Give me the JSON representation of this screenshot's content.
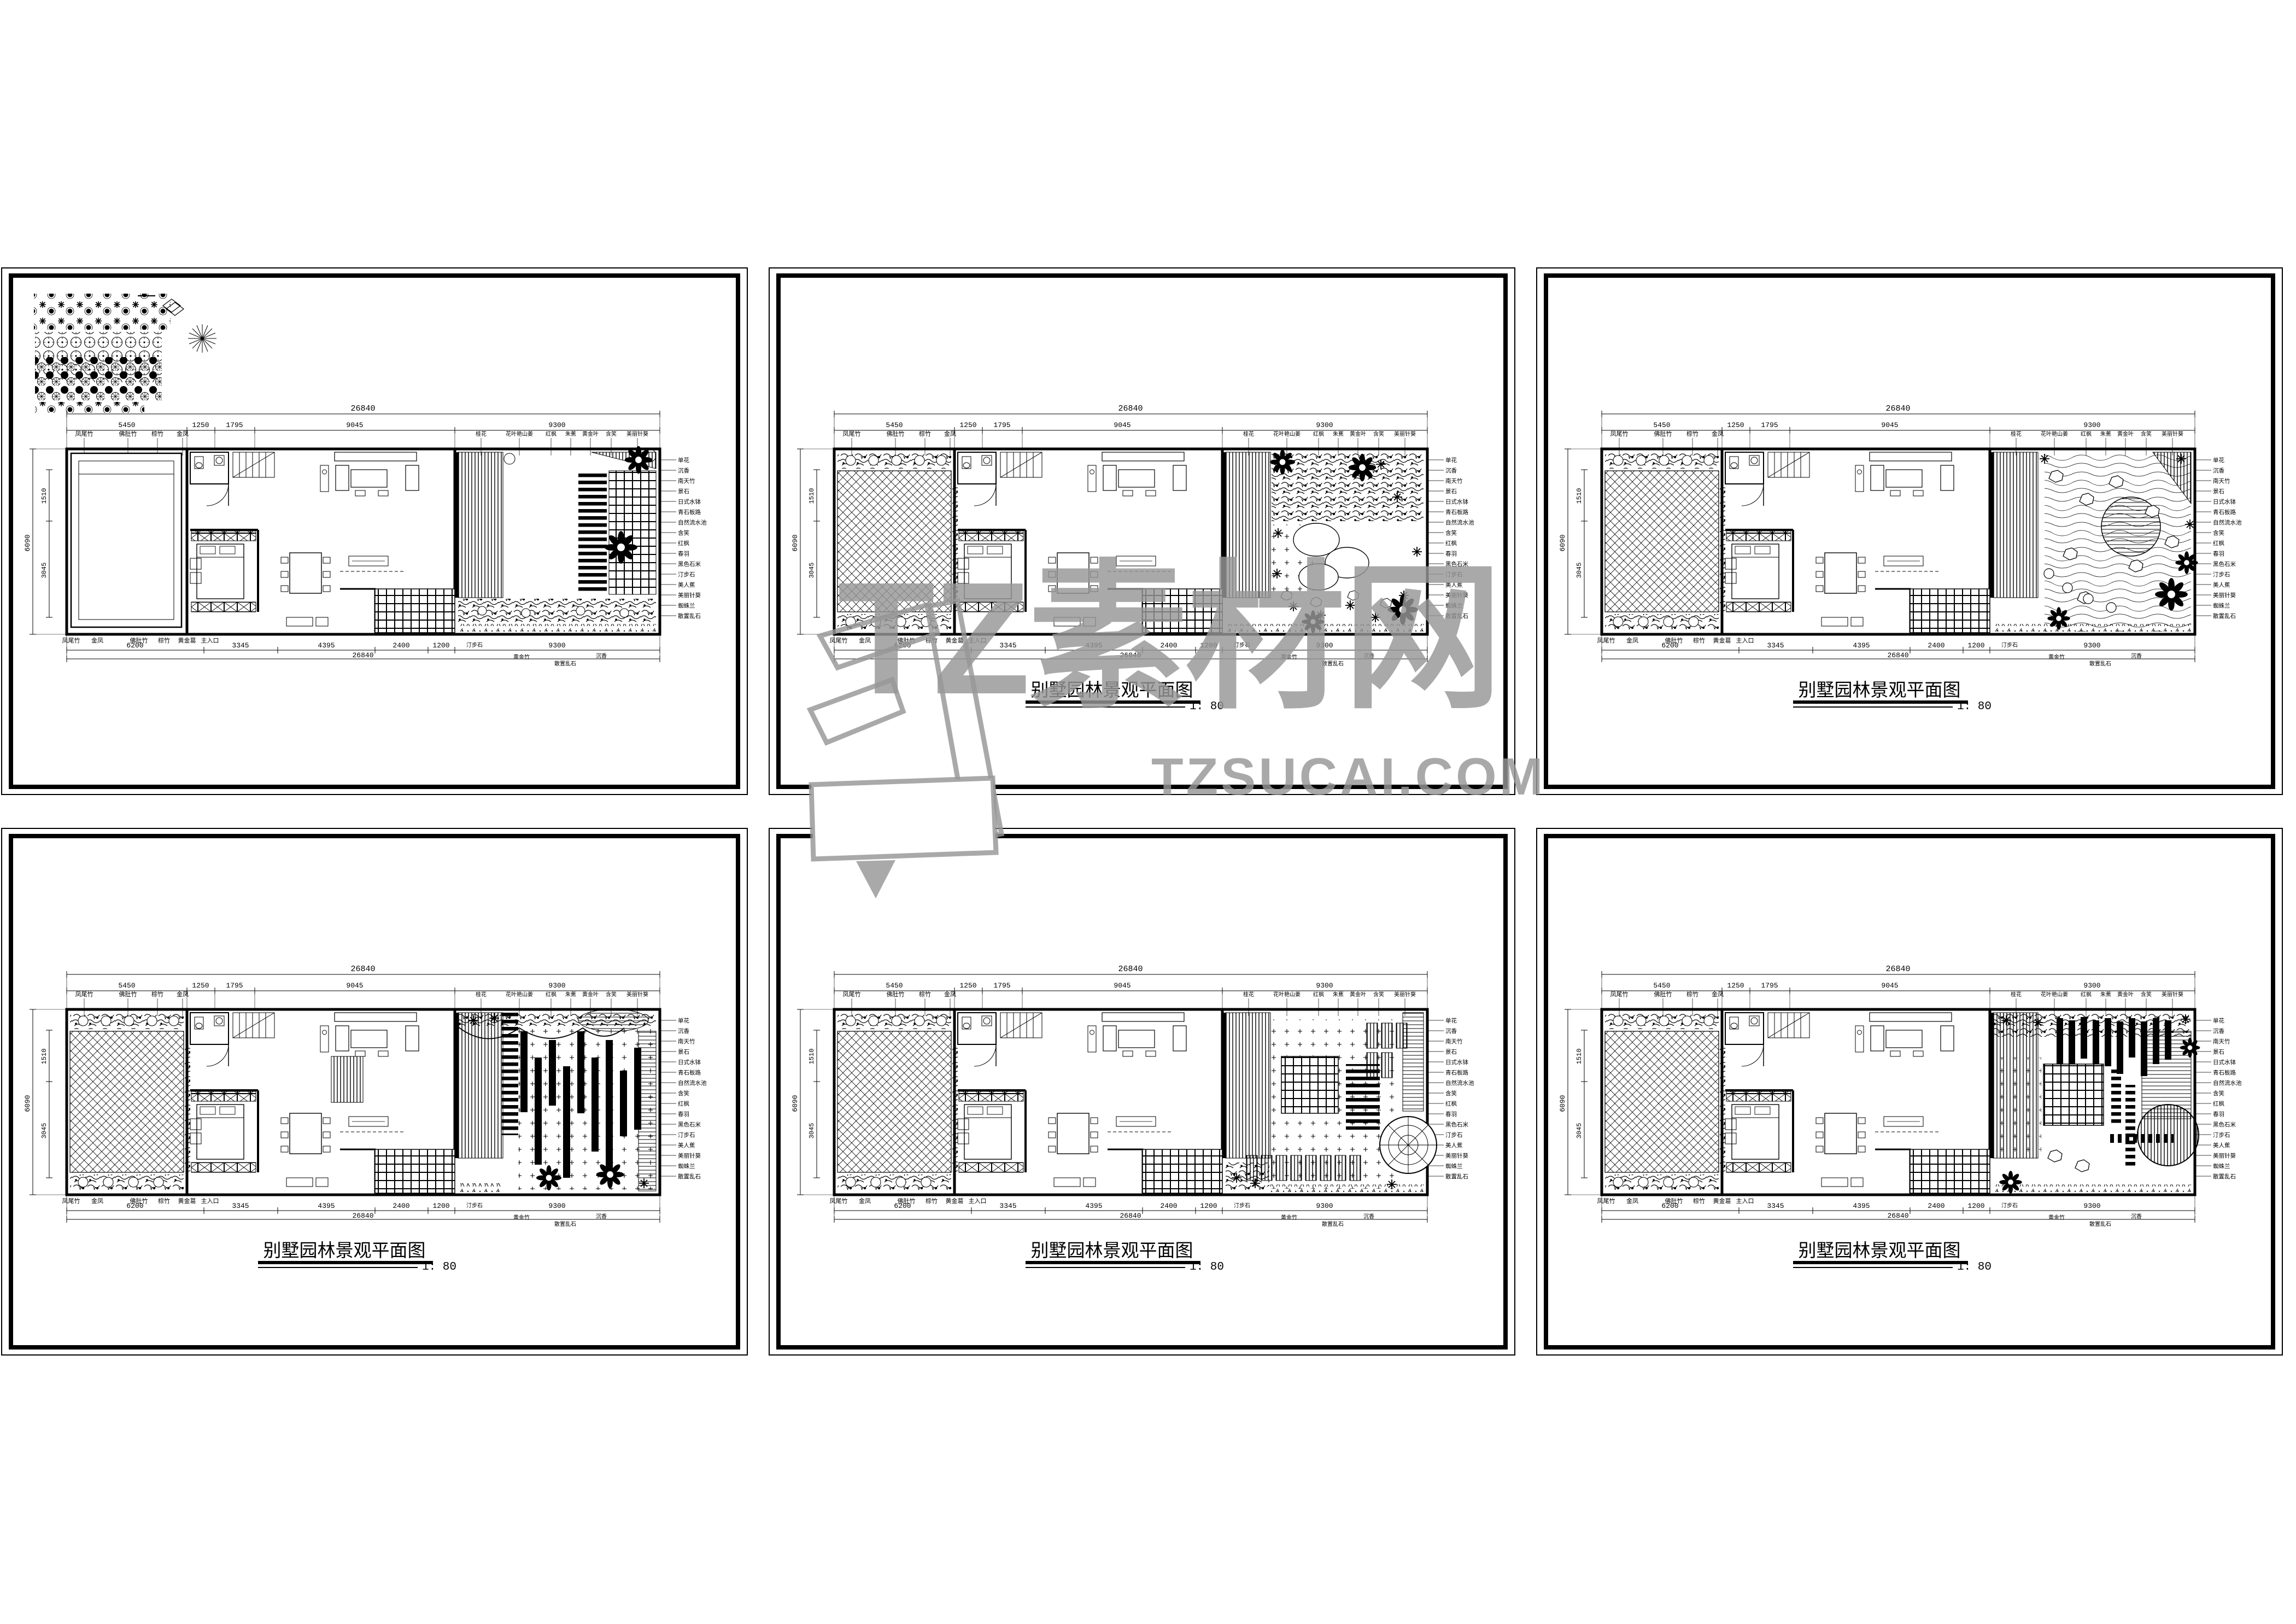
{
  "watermark": {
    "brand": "TZ素材网",
    "url": "TZSUCAI.COM",
    "color": "#969696"
  },
  "title": {
    "text": "别墅园林景观平面图",
    "scale": "1: 80"
  },
  "plan": {
    "dims": {
      "total": "26840",
      "top": [
        "5450",
        "1250",
        "1795",
        "9045",
        "9300"
      ],
      "bottom": [
        "6200",
        "3345",
        "4395",
        "2400",
        "1200",
        "9300"
      ],
      "left": [
        "6090",
        "1510",
        "3045"
      ]
    },
    "labels": {
      "top_left": [
        "凤尾竹",
        "佛肚竹",
        "棕竹",
        "金凤"
      ],
      "top_right": [
        "桂花",
        "花叶艳山姜",
        "红枫",
        "朱蕉",
        "黄金叶",
        "含笑",
        "美丽针葵"
      ],
      "bottom": [
        "凤尾竹",
        "金凤",
        "佛肚竹",
        "棕竹",
        "黄金葛",
        "主入口"
      ],
      "bottom_extra": [
        "汀步石",
        "黄金竹",
        "散置乱石",
        "沉香"
      ],
      "right": [
        "单花",
        "沉香",
        "南天竹",
        "景石",
        "日式水钵",
        "青石板路",
        "自然流水池",
        "含笑",
        "红枫",
        "春羽",
        "黑色石米",
        "汀步石",
        "美人蕉",
        "美丽针葵",
        "蜘蛛兰",
        "散置乱石"
      ]
    }
  },
  "sheets": [
    {
      "id": "sheet-1",
      "has_title": false,
      "note": "plan with plant legend block"
    },
    {
      "id": "sheet-2",
      "has_title": true
    },
    {
      "id": "sheet-3",
      "has_title": true
    },
    {
      "id": "sheet-4",
      "has_title": true
    },
    {
      "id": "sheet-5",
      "has_title": true
    },
    {
      "id": "sheet-6",
      "has_title": true
    }
  ]
}
